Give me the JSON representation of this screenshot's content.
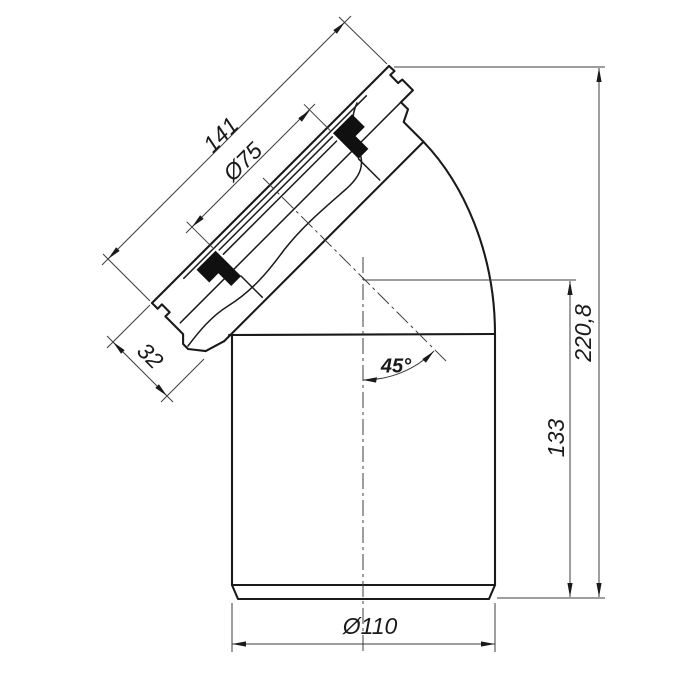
{
  "drawing": {
    "type": "technical-drawing",
    "subject": "45-degree pipe bend with sealed socket flange",
    "dimensions": {
      "flange_width": "141",
      "bore_diameter": "Ø75",
      "socket_depth": "32",
      "bend_angle": "45°",
      "total_height": "220,8",
      "body_height": "133",
      "pipe_diameter": "Ø110"
    },
    "colors": {
      "line": "#1a1a1a",
      "thin": "#3d3d3d",
      "seal": "#101010",
      "bg": "#ffffff"
    }
  }
}
